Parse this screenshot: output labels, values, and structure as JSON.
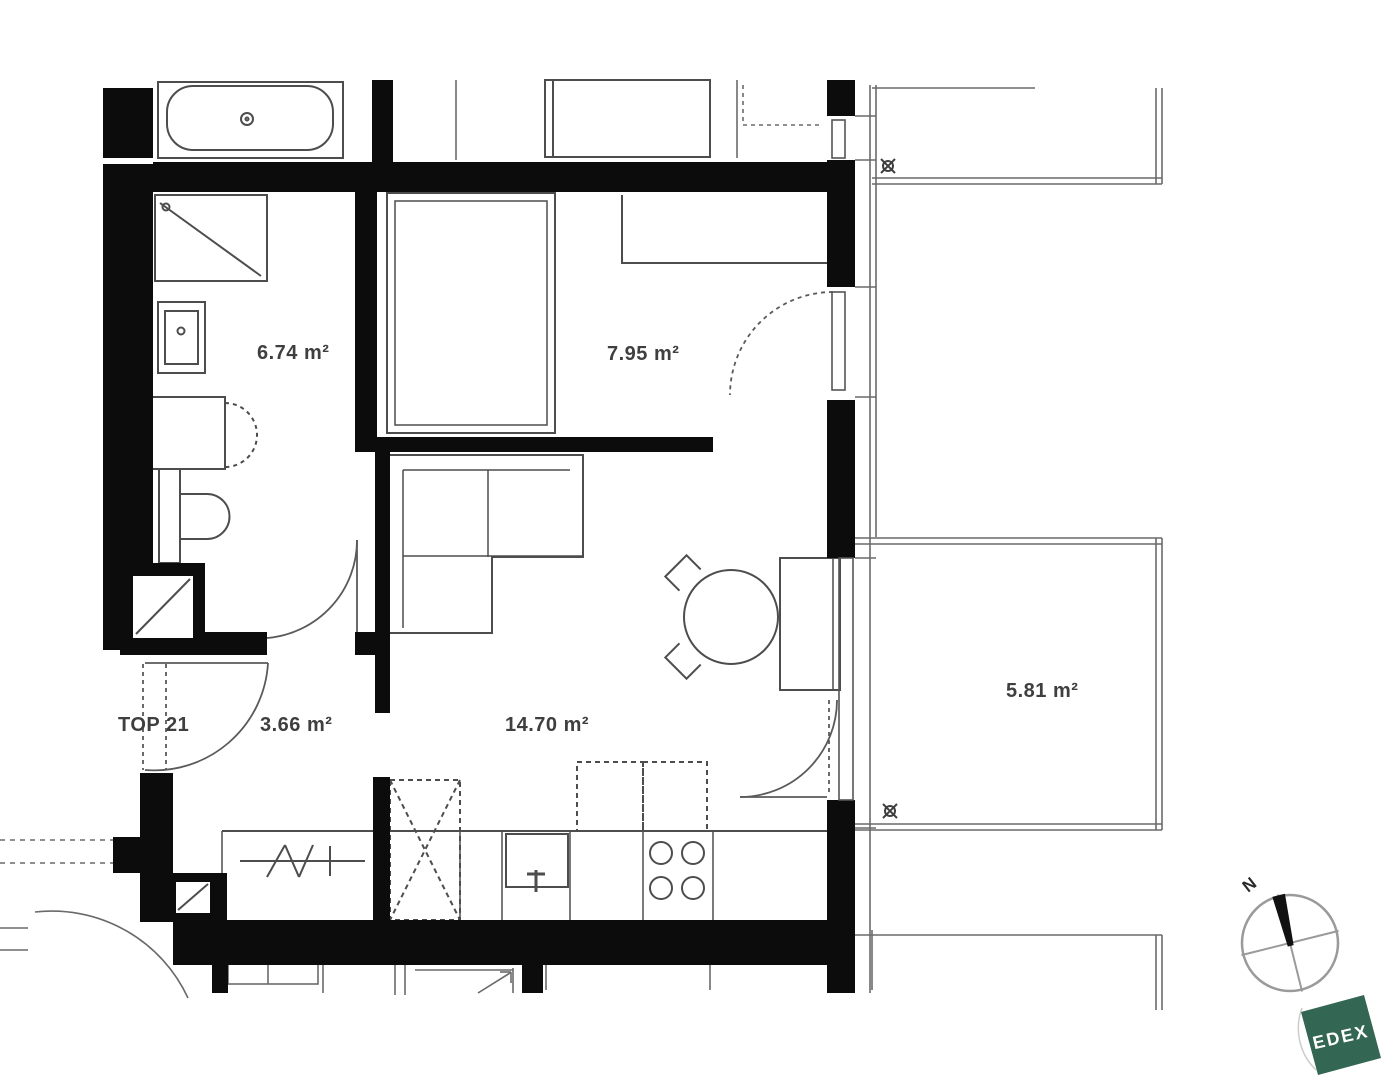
{
  "plan": {
    "unit_label": "TOP 21",
    "rooms": [
      {
        "id": "bathroom",
        "area_label": "6.74 m²"
      },
      {
        "id": "bedroom",
        "area_label": "7.95 m²"
      },
      {
        "id": "hallway",
        "area_label": "3.66 m²"
      },
      {
        "id": "living-kitchen",
        "area_label": "14.70 m²"
      },
      {
        "id": "balcony",
        "area_label": "5.81 m²"
      }
    ],
    "compass": {
      "north_label": "N"
    },
    "logo": {
      "text": "EDEX",
      "color": "#336653"
    },
    "colors": {
      "wall": "#0c0c0c",
      "line": "#4d4d4d",
      "text": "#3f3f3f"
    }
  }
}
